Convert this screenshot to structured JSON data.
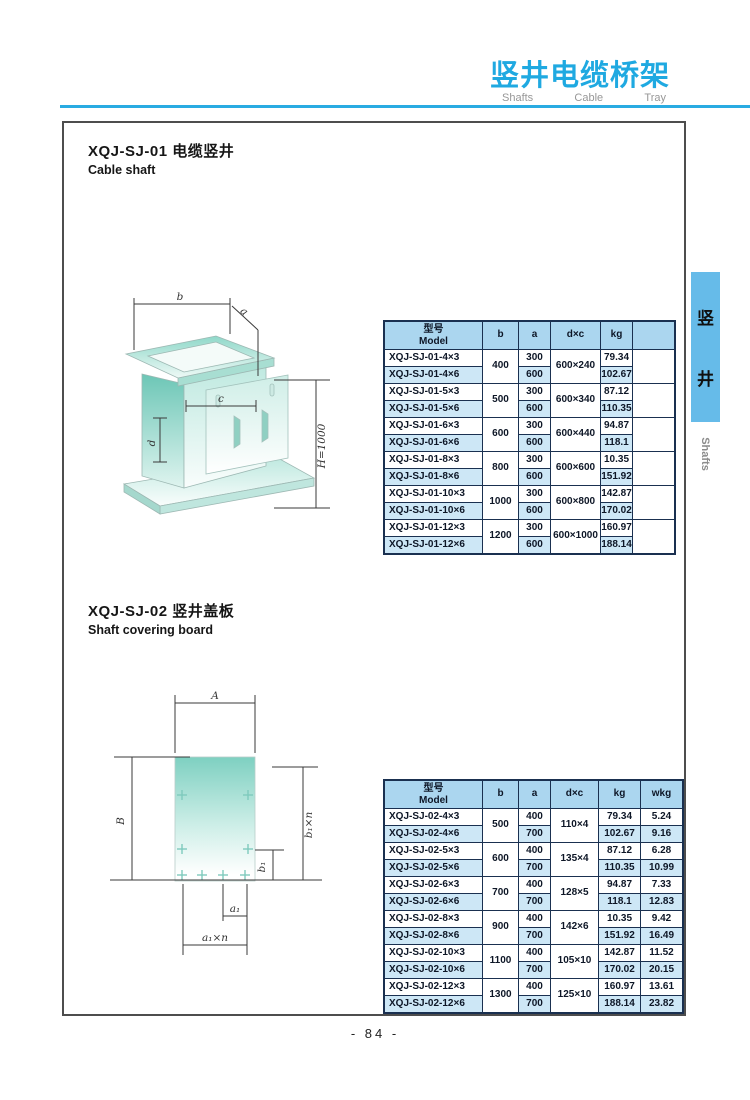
{
  "colors": {
    "accent": "#1fa9e1",
    "rule": "#29abe2",
    "tab-bg": "#66bbe9",
    "frame": "#4d4d4d",
    "table-border": "#1a3050",
    "table-header-bg": "#abd6ef",
    "row-shade-bg": "#cde7f6",
    "teal": "#7fd0c1"
  },
  "header": {
    "title": "竖井电缆桥架",
    "subtitle_words": [
      "Shafts",
      "Cable",
      "Tray"
    ]
  },
  "side_tab": {
    "chars": [
      "竖",
      "井"
    ],
    "en": "Shafts"
  },
  "page_number": "- 84 -",
  "sections": [
    {
      "title_cn": "XQJ-SJ-01 电缆竖井",
      "title_en": "Cable shaft",
      "drawing": {
        "labels": {
          "b": "b",
          "a": "a",
          "c": "c",
          "d": "d",
          "H": "H=1000"
        }
      },
      "table": {
        "model_header": {
          "cn": "型号",
          "en": "Model"
        },
        "col_headers": [
          "b",
          "a",
          "d×c",
          "kg",
          ""
        ],
        "groups": [
          {
            "b": "400",
            "dxc": "600×240",
            "rows": [
              {
                "model": "XQJ-SJ-01-4×3",
                "a": "300",
                "kg": "79.34"
              },
              {
                "model": "XQJ-SJ-01-4×6",
                "a": "600",
                "kg": "102.67"
              }
            ]
          },
          {
            "b": "500",
            "dxc": "600×340",
            "rows": [
              {
                "model": "XQJ-SJ-01-5×3",
                "a": "300",
                "kg": "87.12"
              },
              {
                "model": "XQJ-SJ-01-5×6",
                "a": "600",
                "kg": "110.35"
              }
            ]
          },
          {
            "b": "600",
            "dxc": "600×440",
            "rows": [
              {
                "model": "XQJ-SJ-01-6×3",
                "a": "300",
                "kg": "94.87"
              },
              {
                "model": "XQJ-SJ-01-6×6",
                "a": "600",
                "kg": "118.1"
              }
            ]
          },
          {
            "b": "800",
            "dxc": "600×600",
            "rows": [
              {
                "model": "XQJ-SJ-01-8×3",
                "a": "300",
                "kg": "10.35"
              },
              {
                "model": "XQJ-SJ-01-8×6",
                "a": "600",
                "kg": "151.92"
              }
            ]
          },
          {
            "b": "1000",
            "dxc": "600×800",
            "rows": [
              {
                "model": "XQJ-SJ-01-10×3",
                "a": "300",
                "kg": "142.87"
              },
              {
                "model": "XQJ-SJ-01-10×6",
                "a": "600",
                "kg": "170.02"
              }
            ]
          },
          {
            "b": "1200",
            "dxc": "600×1000",
            "rows": [
              {
                "model": "XQJ-SJ-01-12×3",
                "a": "300",
                "kg": "160.97"
              },
              {
                "model": "XQJ-SJ-01-12×6",
                "a": "600",
                "kg": "188.14"
              }
            ]
          }
        ]
      }
    },
    {
      "title_cn": "XQJ-SJ-02 竖井盖板",
      "title_en": "Shaft covering board",
      "drawing": {
        "labels": {
          "A": "A",
          "B": "B",
          "b1n": "b₁×n",
          "b1": "b₁",
          "a1": "a₁",
          "a1n": "a₁×n"
        }
      },
      "table": {
        "model_header": {
          "cn": "型号",
          "en": "Model"
        },
        "col_headers": [
          "b",
          "a",
          "d×c",
          "kg",
          "wkg"
        ],
        "groups": [
          {
            "b": "500",
            "dxc": "110×4",
            "rows": [
              {
                "model": "XQJ-SJ-02-4×3",
                "a": "400",
                "kg": "79.34",
                "wkg": "5.24"
              },
              {
                "model": "XQJ-SJ-02-4×6",
                "a": "700",
                "kg": "102.67",
                "wkg": "9.16"
              }
            ]
          },
          {
            "b": "600",
            "dxc": "135×4",
            "rows": [
              {
                "model": "XQJ-SJ-02-5×3",
                "a": "400",
                "kg": "87.12",
                "wkg": "6.28"
              },
              {
                "model": "XQJ-SJ-02-5×6",
                "a": "700",
                "kg": "110.35",
                "wkg": "10.99"
              }
            ]
          },
          {
            "b": "700",
            "dxc": "128×5",
            "rows": [
              {
                "model": "XQJ-SJ-02-6×3",
                "a": "400",
                "kg": "94.87",
                "wkg": "7.33"
              },
              {
                "model": "XQJ-SJ-02-6×6",
                "a": "700",
                "kg": "118.1",
                "wkg": "12.83"
              }
            ]
          },
          {
            "b": "900",
            "dxc": "142×6",
            "rows": [
              {
                "model": "XQJ-SJ-02-8×3",
                "a": "400",
                "kg": "10.35",
                "wkg": "9.42"
              },
              {
                "model": "XQJ-SJ-02-8×6",
                "a": "700",
                "kg": "151.92",
                "wkg": "16.49"
              }
            ]
          },
          {
            "b": "1100",
            "dxc": "105×10",
            "rows": [
              {
                "model": "XQJ-SJ-02-10×3",
                "a": "400",
                "kg": "142.87",
                "wkg": "11.52"
              },
              {
                "model": "XQJ-SJ-02-10×6",
                "a": "700",
                "kg": "170.02",
                "wkg": "20.15"
              }
            ]
          },
          {
            "b": "1300",
            "dxc": "125×10",
            "rows": [
              {
                "model": "XQJ-SJ-02-12×3",
                "a": "400",
                "kg": "160.97",
                "wkg": "13.61"
              },
              {
                "model": "XQJ-SJ-02-12×6",
                "a": "700",
                "kg": "188.14",
                "wkg": "23.82"
              }
            ]
          }
        ]
      }
    }
  ]
}
